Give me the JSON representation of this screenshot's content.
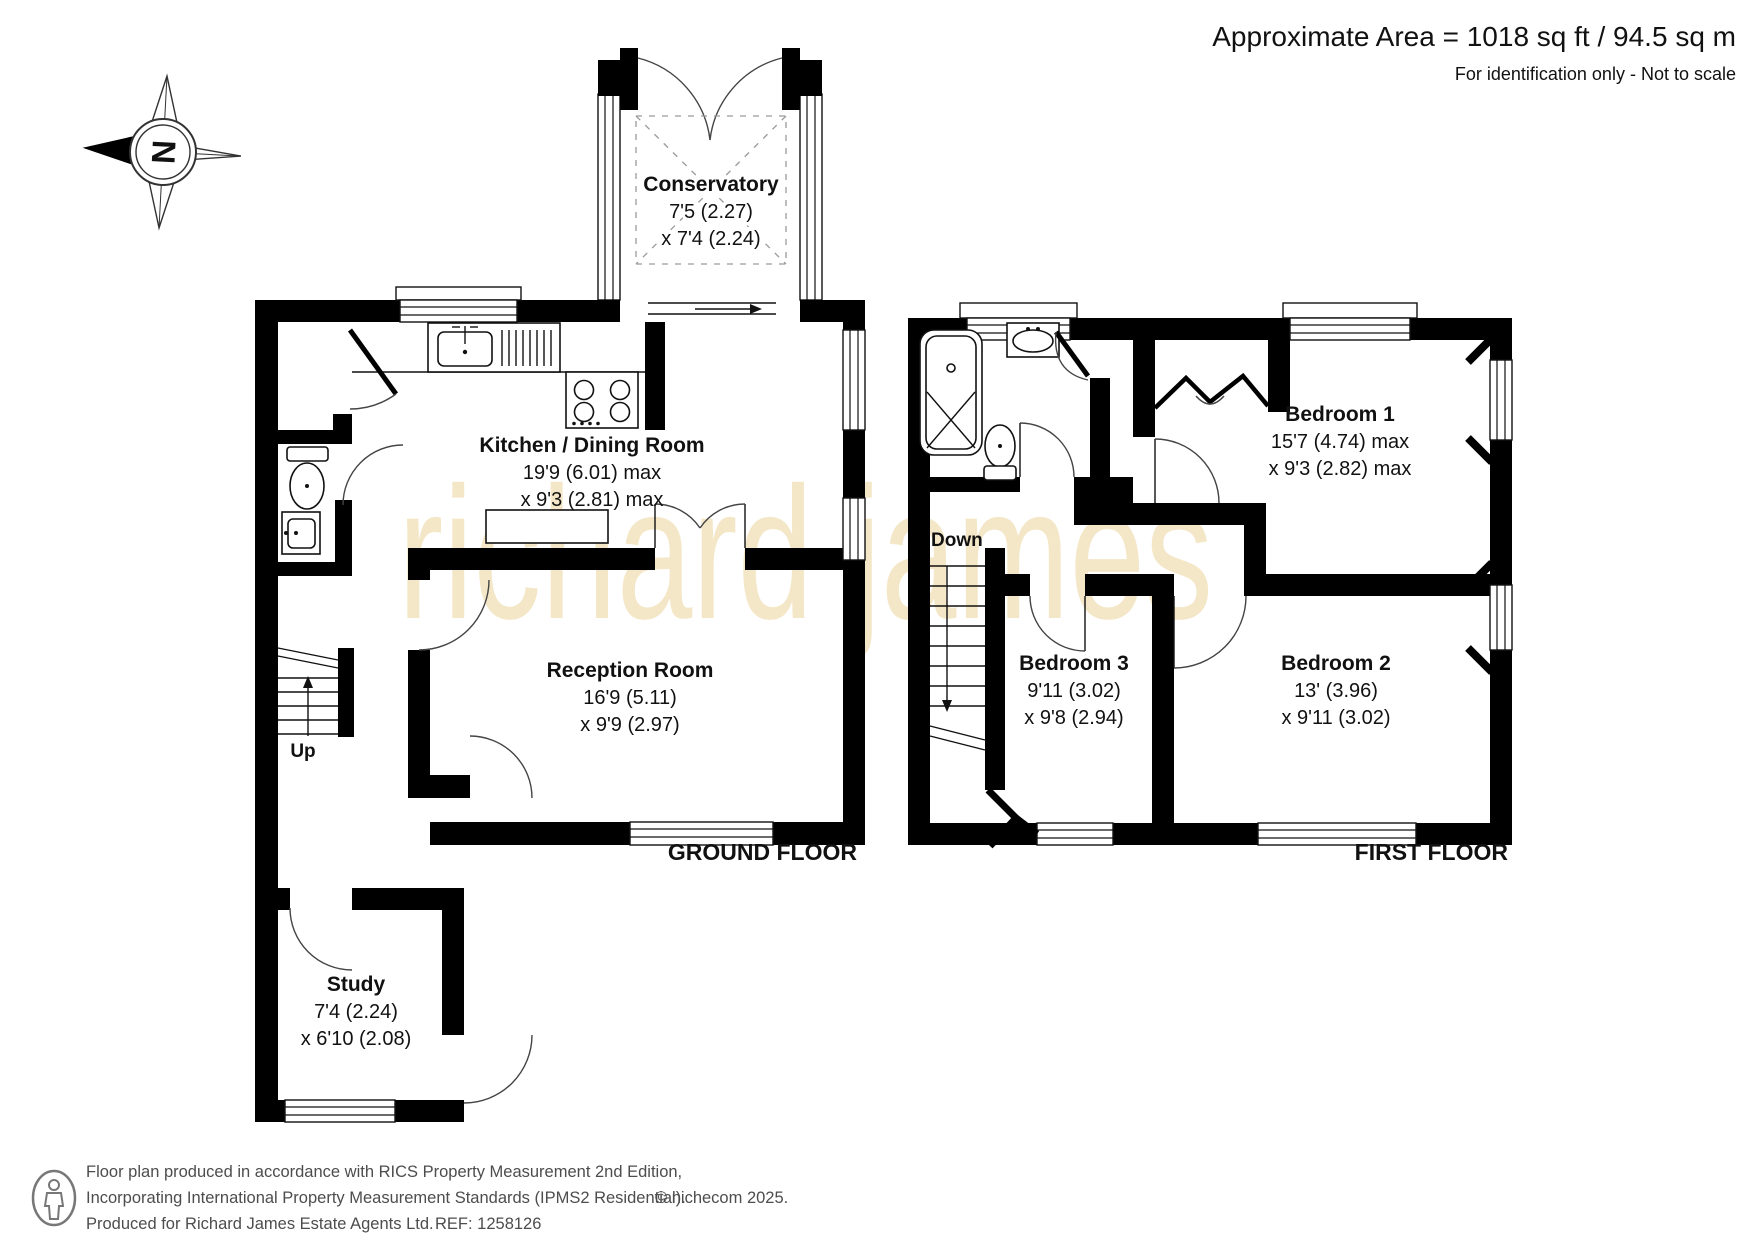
{
  "header": {
    "area": "Approximate Area = 1018 sq ft / 94.5 sq m",
    "note": "For identification only - Not to scale"
  },
  "compass": {
    "north": "N"
  },
  "watermark": "richard james",
  "ground_floor": {
    "label": "GROUND FLOOR",
    "stairs": "Up",
    "rooms": {
      "conservatory": {
        "name": "Conservatory",
        "dim1": "7'5 (2.27)",
        "dim2": "x 7'4 (2.24)"
      },
      "kitchen_dining": {
        "name": "Kitchen / Dining Room",
        "dim1": "19'9 (6.01) max",
        "dim2": "x 9'3 (2.81) max"
      },
      "reception": {
        "name": "Reception Room",
        "dim1": "16'9 (5.11)",
        "dim2": "x 9'9 (2.97)"
      },
      "study": {
        "name": "Study",
        "dim1": "7'4 (2.24)",
        "dim2": "x 6'10 (2.08)"
      }
    }
  },
  "first_floor": {
    "label": "FIRST FLOOR",
    "stairs": "Down",
    "rooms": {
      "bedroom1": {
        "name": "Bedroom 1",
        "dim1": "15'7 (4.74) max",
        "dim2": "x 9'3 (2.82) max"
      },
      "bedroom2": {
        "name": "Bedroom 2",
        "dim1": "13' (3.96)",
        "dim2": "x 9'11 (3.02)"
      },
      "bedroom3": {
        "name": "Bedroom 3",
        "dim1": "9'11 (3.02)",
        "dim2": "x 9'8 (2.94)"
      }
    }
  },
  "footer": {
    "line1": "Floor plan produced in accordance with RICS Property Measurement 2nd Edition,",
    "line2": "Incorporating International Property Measurement Standards (IPMS2 Residential).",
    "copyright": "© nichecom 2025.",
    "line3": "Produced for Richard James Estate Agents Ltd.",
    "ref": "REF: 1258126"
  },
  "colors": {
    "wall": "#000000",
    "watermark": "#f4e7c7",
    "text": "#111111",
    "footer_text": "#4d4d4d"
  }
}
